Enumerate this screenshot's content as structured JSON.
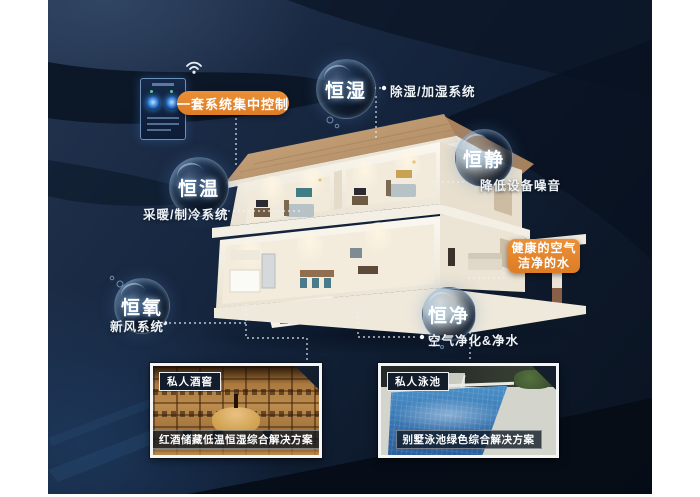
{
  "colors": {
    "accent_orange": "#e0832c",
    "panel_navy": "#13233c",
    "bubble_rim_blue": "#9fc4e8",
    "text_white": "#ffffff"
  },
  "control": {
    "label": "一套系统集中控制",
    "wifi_icon": "wifi",
    "device": "smart-home-control-screen"
  },
  "callouts": {
    "humidity": {
      "bubble": "恒湿",
      "label": "除湿/加湿系统"
    },
    "quiet": {
      "bubble": "恒静",
      "label": "降低设备噪音"
    },
    "temperature": {
      "bubble": "恒温",
      "label": "采暖/制冷系统"
    },
    "oxygen": {
      "bubble": "恒氧",
      "label": "新风系统"
    },
    "purity": {
      "bubble": "恒净",
      "label": "空气净化&净水"
    }
  },
  "highlight": {
    "line1": "健康的空气",
    "line2": "洁净的水"
  },
  "cards": {
    "wine": {
      "tag": "私人酒窖",
      "caption": "红酒储藏低温恒湿综合解决方案"
    },
    "pool": {
      "tag": "私人泳池",
      "caption": "别墅泳池绿色综合解决方案"
    }
  }
}
